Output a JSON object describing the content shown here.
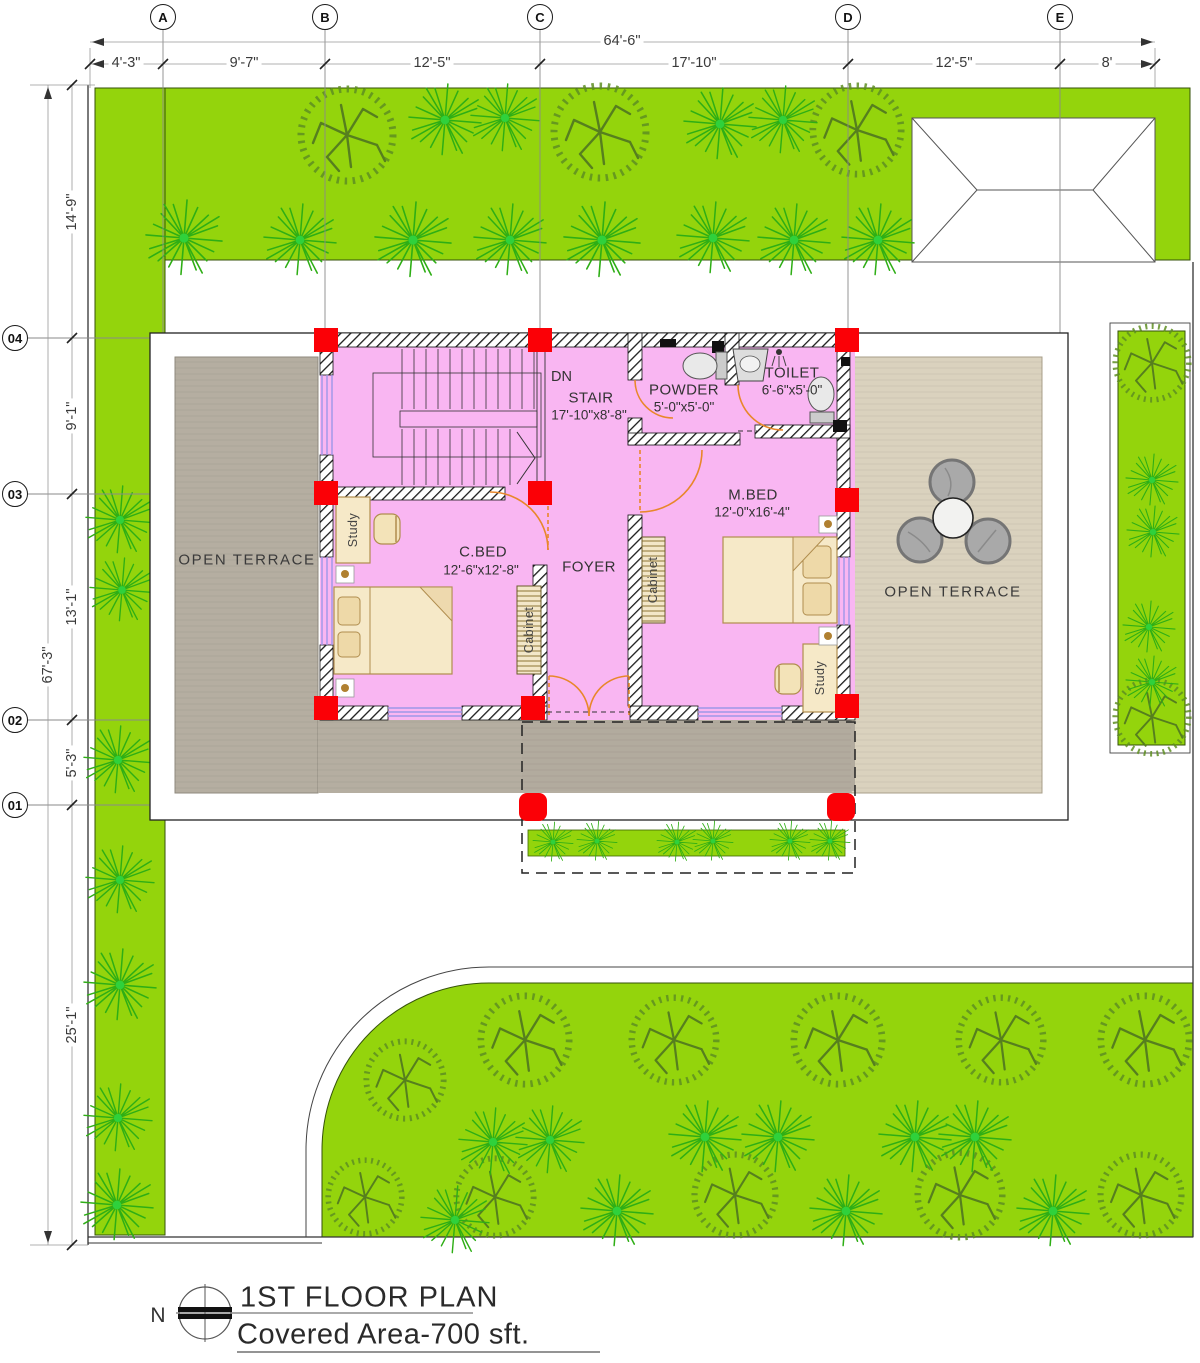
{
  "title_block": {
    "north_label": "N",
    "title": "1ST FLOOR PLAN",
    "subtitle": "Covered Area-700 sft."
  },
  "grid": {
    "cols": [
      {
        "label": "A"
      },
      {
        "label": "B"
      },
      {
        "label": "C"
      },
      {
        "label": "D"
      },
      {
        "label": "E"
      }
    ],
    "rows": [
      {
        "label": "04"
      },
      {
        "label": "03"
      },
      {
        "label": "02"
      },
      {
        "label": "01"
      }
    ]
  },
  "dims": {
    "top_overall": "64'-6\"",
    "top_segments": [
      "4'-3\"",
      "9'-7\"",
      "12'-5\"",
      "17'-10\"",
      "12'-5\"",
      "8'"
    ],
    "left_overall": "67'-3\"",
    "left_segments": [
      "14'-9\"",
      "9'-1\"",
      "13'-1\"",
      "5'-3\"",
      "25'-1\""
    ]
  },
  "rooms": {
    "stair": {
      "name": "STAIR",
      "size": "17'-10\"x8'-8\"",
      "note": "DN"
    },
    "powder": {
      "name": "POWDER",
      "size": "5'-0\"x5'-0\""
    },
    "toilet": {
      "name": "TOILET",
      "size": "6'-6\"x5'-0\""
    },
    "cbed": {
      "name": "C.BED",
      "size": "12'-6\"x12'-8\""
    },
    "mbed": {
      "name": "M.BED",
      "size": "12'-0\"x16'-4\""
    },
    "foyer": {
      "name": "FOYER"
    },
    "terrace_left": {
      "name": "OPEN TERRACE"
    },
    "terrace_right": {
      "name": "OPEN TERRACE"
    }
  },
  "furniture": {
    "study": "Study",
    "cabinet": "Cabinet"
  },
  "colors": {
    "lawn": "#94d40c",
    "room_pink": "#f9b6f2",
    "column_red": "#fb0006",
    "terrace_left_gray": "#b5aea1",
    "terrace_right_beige": "#dad2be",
    "door_arc_orange": "#e8872a",
    "window_blue": "#9d97e8"
  },
  "flora": {
    "trees": [
      [
        347,
        135,
        50
      ],
      [
        600,
        132,
        50
      ],
      [
        857,
        130,
        48
      ],
      [
        1152,
        363,
        40
      ],
      [
        1152,
        717,
        40
      ],
      [
        525,
        1040,
        48
      ],
      [
        674,
        1040,
        46
      ],
      [
        838,
        1040,
        48
      ],
      [
        1001,
        1040,
        46
      ],
      [
        1145,
        1040,
        48
      ],
      [
        405,
        1080,
        42
      ],
      [
        365,
        1197,
        40
      ],
      [
        495,
        1197,
        42
      ],
      [
        735,
        1195,
        44
      ],
      [
        960,
        1195,
        46
      ],
      [
        1141,
        1195,
        44
      ]
    ],
    "palms": [
      [
        445,
        120,
        36
      ],
      [
        505,
        118,
        34
      ],
      [
        720,
        124,
        36
      ],
      [
        783,
        120,
        34
      ],
      [
        184,
        238,
        38
      ],
      [
        300,
        240,
        36
      ],
      [
        413,
        240,
        38
      ],
      [
        510,
        240,
        36
      ],
      [
        602,
        240,
        38
      ],
      [
        713,
        238,
        36
      ],
      [
        794,
        240,
        36
      ],
      [
        878,
        240,
        36
      ],
      [
        120,
        520,
        34
      ],
      [
        122,
        590,
        32
      ],
      [
        118,
        760,
        34
      ],
      [
        120,
        880,
        34
      ],
      [
        120,
        985,
        36
      ],
      [
        118,
        1118,
        34
      ],
      [
        117,
        1205,
        36
      ],
      [
        1152,
        480,
        26
      ],
      [
        1153,
        532,
        26
      ],
      [
        1149,
        627,
        26
      ],
      [
        1152,
        682,
        26
      ],
      [
        493,
        1142,
        34
      ],
      [
        550,
        1140,
        34
      ],
      [
        705,
        1137,
        36
      ],
      [
        778,
        1137,
        36
      ],
      [
        915,
        1137,
        36
      ],
      [
        975,
        1137,
        36
      ],
      [
        455,
        1220,
        34
      ],
      [
        617,
        1211,
        36
      ],
      [
        846,
        1211,
        36
      ],
      [
        1053,
        1211,
        36
      ]
    ],
    "balcony_palms": [
      [
        553,
        842,
        20
      ],
      [
        597,
        841,
        20
      ],
      [
        677,
        842,
        20
      ],
      [
        713,
        841,
        20
      ],
      [
        790,
        841,
        20
      ],
      [
        830,
        841,
        20
      ]
    ]
  }
}
